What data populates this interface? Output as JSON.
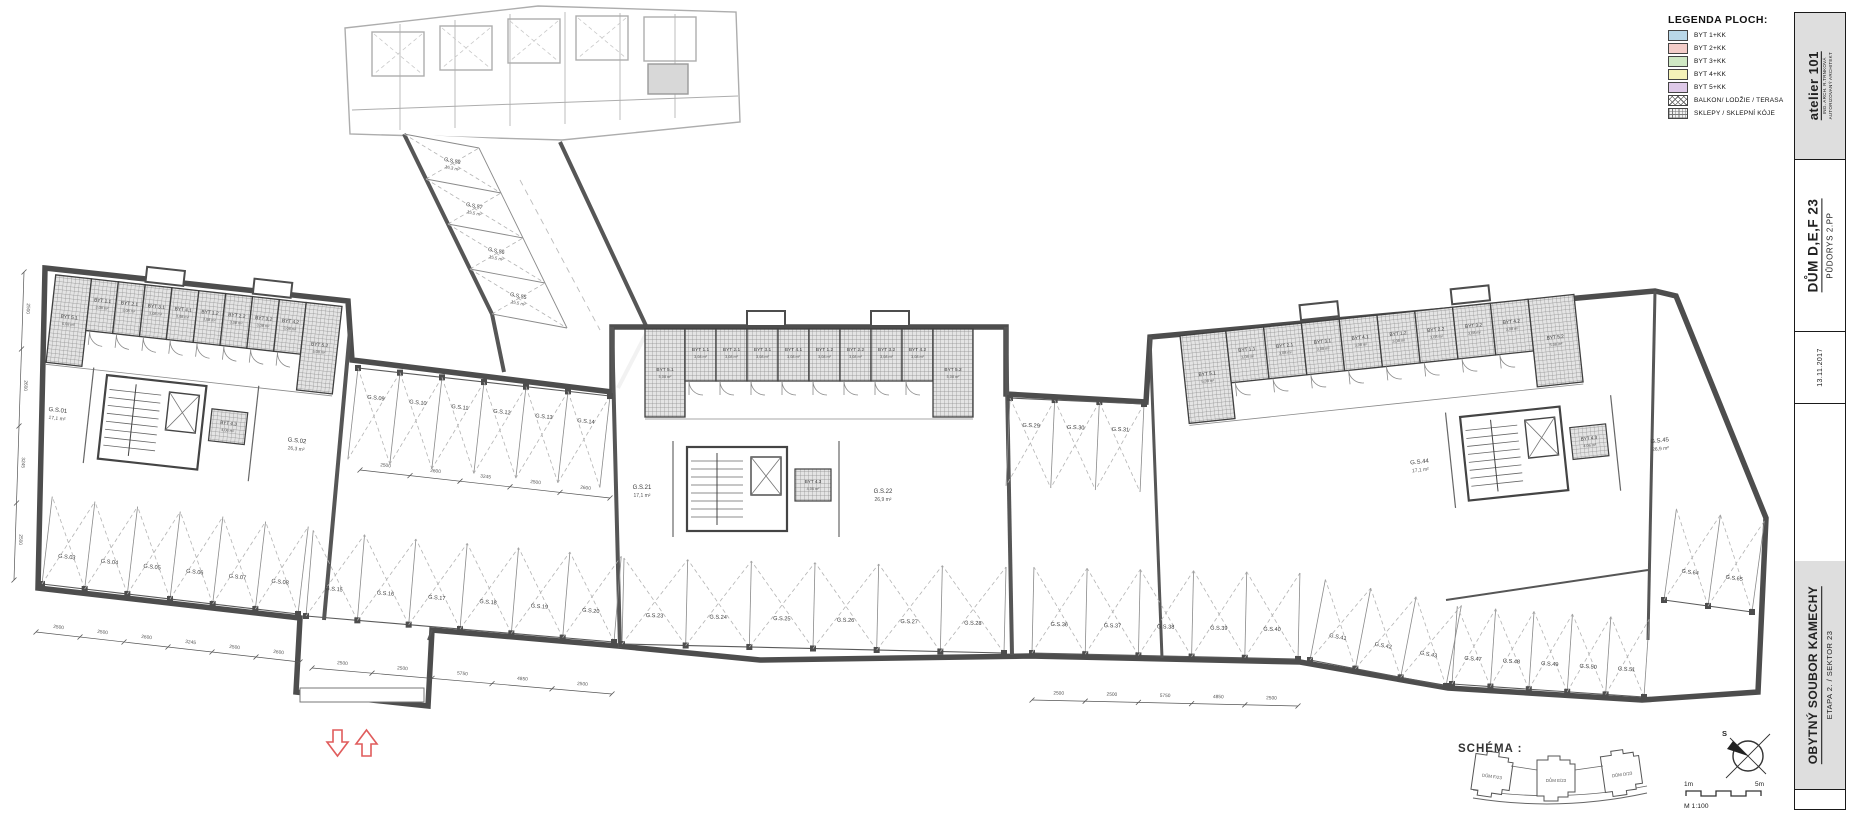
{
  "legend": {
    "title": "LEGENDA PLOCH:",
    "items": [
      {
        "label": "BYT 1+KK",
        "type": "fill",
        "color": "#b9d7e8"
      },
      {
        "label": "BYT 2+KK",
        "type": "fill",
        "color": "#f3cdc9"
      },
      {
        "label": "BYT 3+KK",
        "type": "fill",
        "color": "#cfe8c4"
      },
      {
        "label": "BYT 4+KK",
        "type": "fill",
        "color": "#f5f2b8"
      },
      {
        "label": "BYT 5+KK",
        "type": "fill",
        "color": "#dec9e8"
      },
      {
        "label": "BALKON/ LODŽIE / TERASA",
        "type": "cross"
      },
      {
        "label": "SKLEPY / SKLEPNÍ KÓJE",
        "type": "grid"
      }
    ]
  },
  "title_block": {
    "studio": "atelier 101",
    "studio_sub1": "ING. ARCH. R.TRNKOVÁ",
    "studio_sub2": "AUTORIZOVANÝ ARCHITEKT",
    "project_title": "DŮM D,E,F 23",
    "drawing_title": "PŮDORYS 2.PP",
    "date": "13.11.2017",
    "complex": "OBYTNÝ SOUBOR KAMECHY",
    "stage": "ETAPA 2. / SEKTOR 23"
  },
  "schema": {
    "label": "SCHÉMA :",
    "buildings": [
      "DŮM F/23",
      "DŮM E/23",
      "DŮM D/23"
    ]
  },
  "scale_bar": {
    "left_label": "1m",
    "right_label": "5m",
    "scale_label": "M 1:100"
  },
  "north_label": "S",
  "plan": {
    "cage_labels": [
      "BYT 5.1",
      "BYT 1.1",
      "BYT 2.1",
      "BYT 3.1",
      "BYT 4.1",
      "BYT 1.2",
      "BYT 2.2",
      "BYT 3.2",
      "BYT 4.2",
      "BYT 5.2"
    ],
    "cage_area_mid": "3,08 m²",
    "cage_area_end": "5,08 m²",
    "extra_cage": {
      "label": "BYT 4.3",
      "area": "4,06 m²"
    },
    "core_cells": {
      "left": [
        {
          "label": "G.S.01",
          "area": "17,1 m²"
        },
        {
          "label": "G.S.02",
          "area": "26,3 m²"
        }
      ],
      "center": [
        {
          "label": "G.S.21",
          "area": "17,1 m²"
        },
        {
          "label": "G.S.22",
          "area": "26,9 m²"
        }
      ],
      "right": [
        {
          "label": "G.S.44",
          "area": "17,1 m²"
        },
        {
          "label": "G.S.45",
          "area": "26,9 m²"
        }
      ]
    },
    "corridor_cells": [
      {
        "label": "G.S.58",
        "area": "16,3 m²"
      },
      {
        "label": "G.S.57",
        "area": "15,5 m²"
      },
      {
        "label": "G.S.56",
        "area": "15,5 m²"
      },
      {
        "label": "G.S.55",
        "area": "15,5 m²"
      }
    ],
    "parking_runs": {
      "u1": [
        "G.S.09",
        "G.S.10",
        "G.S.11",
        "G.S.12",
        "G.S.13",
        "G.S.14"
      ],
      "u2": [
        "G.S.29",
        "G.S.30",
        "G.S.31"
      ],
      "l1": [
        "G.S.03",
        "G.S.04",
        "G.S.05",
        "G.S.06",
        "G.S.07",
        "G.S.08"
      ],
      "l2": [
        "G.S.15",
        "G.S.16",
        "G.S.17",
        "G.S.18",
        "G.S.19",
        "G.S.20"
      ],
      "l3": [
        "G.S.23",
        "G.S.24",
        "G.S.25",
        "G.S.26",
        "G.S.27",
        "G.S.28"
      ],
      "l4": [
        "G.S.36",
        "G.S.37",
        "G.S.38",
        "G.S.39",
        "G.S.40"
      ],
      "r1": [
        "G.S.41",
        "G.S.42",
        "G.S.43"
      ],
      "l5": [
        "G.S.47",
        "G.S.48",
        "G.S.49",
        "G.S.50",
        "G.S.51"
      ],
      "fr": [
        "G.S.64",
        "G.S.65"
      ]
    },
    "dimensions": [
      "2500",
      "2500",
      "2600",
      "3245",
      "2500",
      "2600",
      "2500",
      "2500",
      "5750",
      "4850"
    ]
  }
}
